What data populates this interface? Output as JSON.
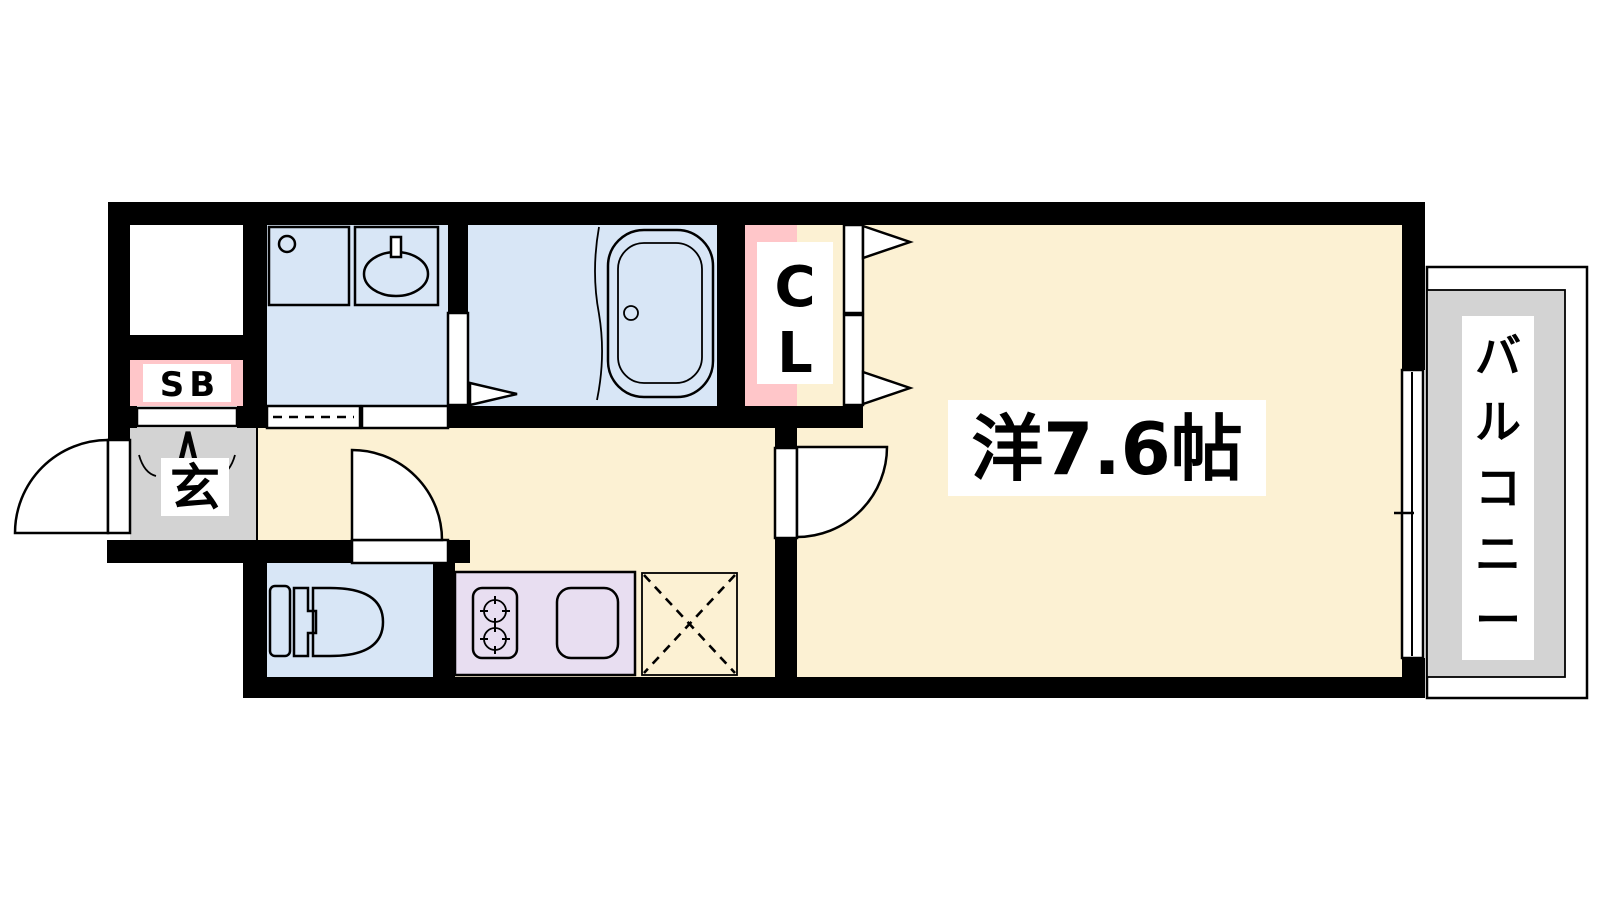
{
  "rooms": {
    "main_room": {
      "label": "洋7.6帖"
    },
    "balcony": {
      "label": "バルコニー"
    },
    "closet": {
      "label": "CL"
    },
    "entrance": {
      "label": "玄"
    },
    "shoe_box": {
      "label": "SB"
    }
  },
  "colors": {
    "wall_black": "#000000",
    "room_cream": "#FCF1D3",
    "wet_area_blue": "#D8E6F6",
    "accent_pink": "#FFC6C9",
    "kitchen_purple": "#E8DEF1",
    "balcony_gray": "#D3D3D3",
    "background": "#FFFFFF"
  }
}
